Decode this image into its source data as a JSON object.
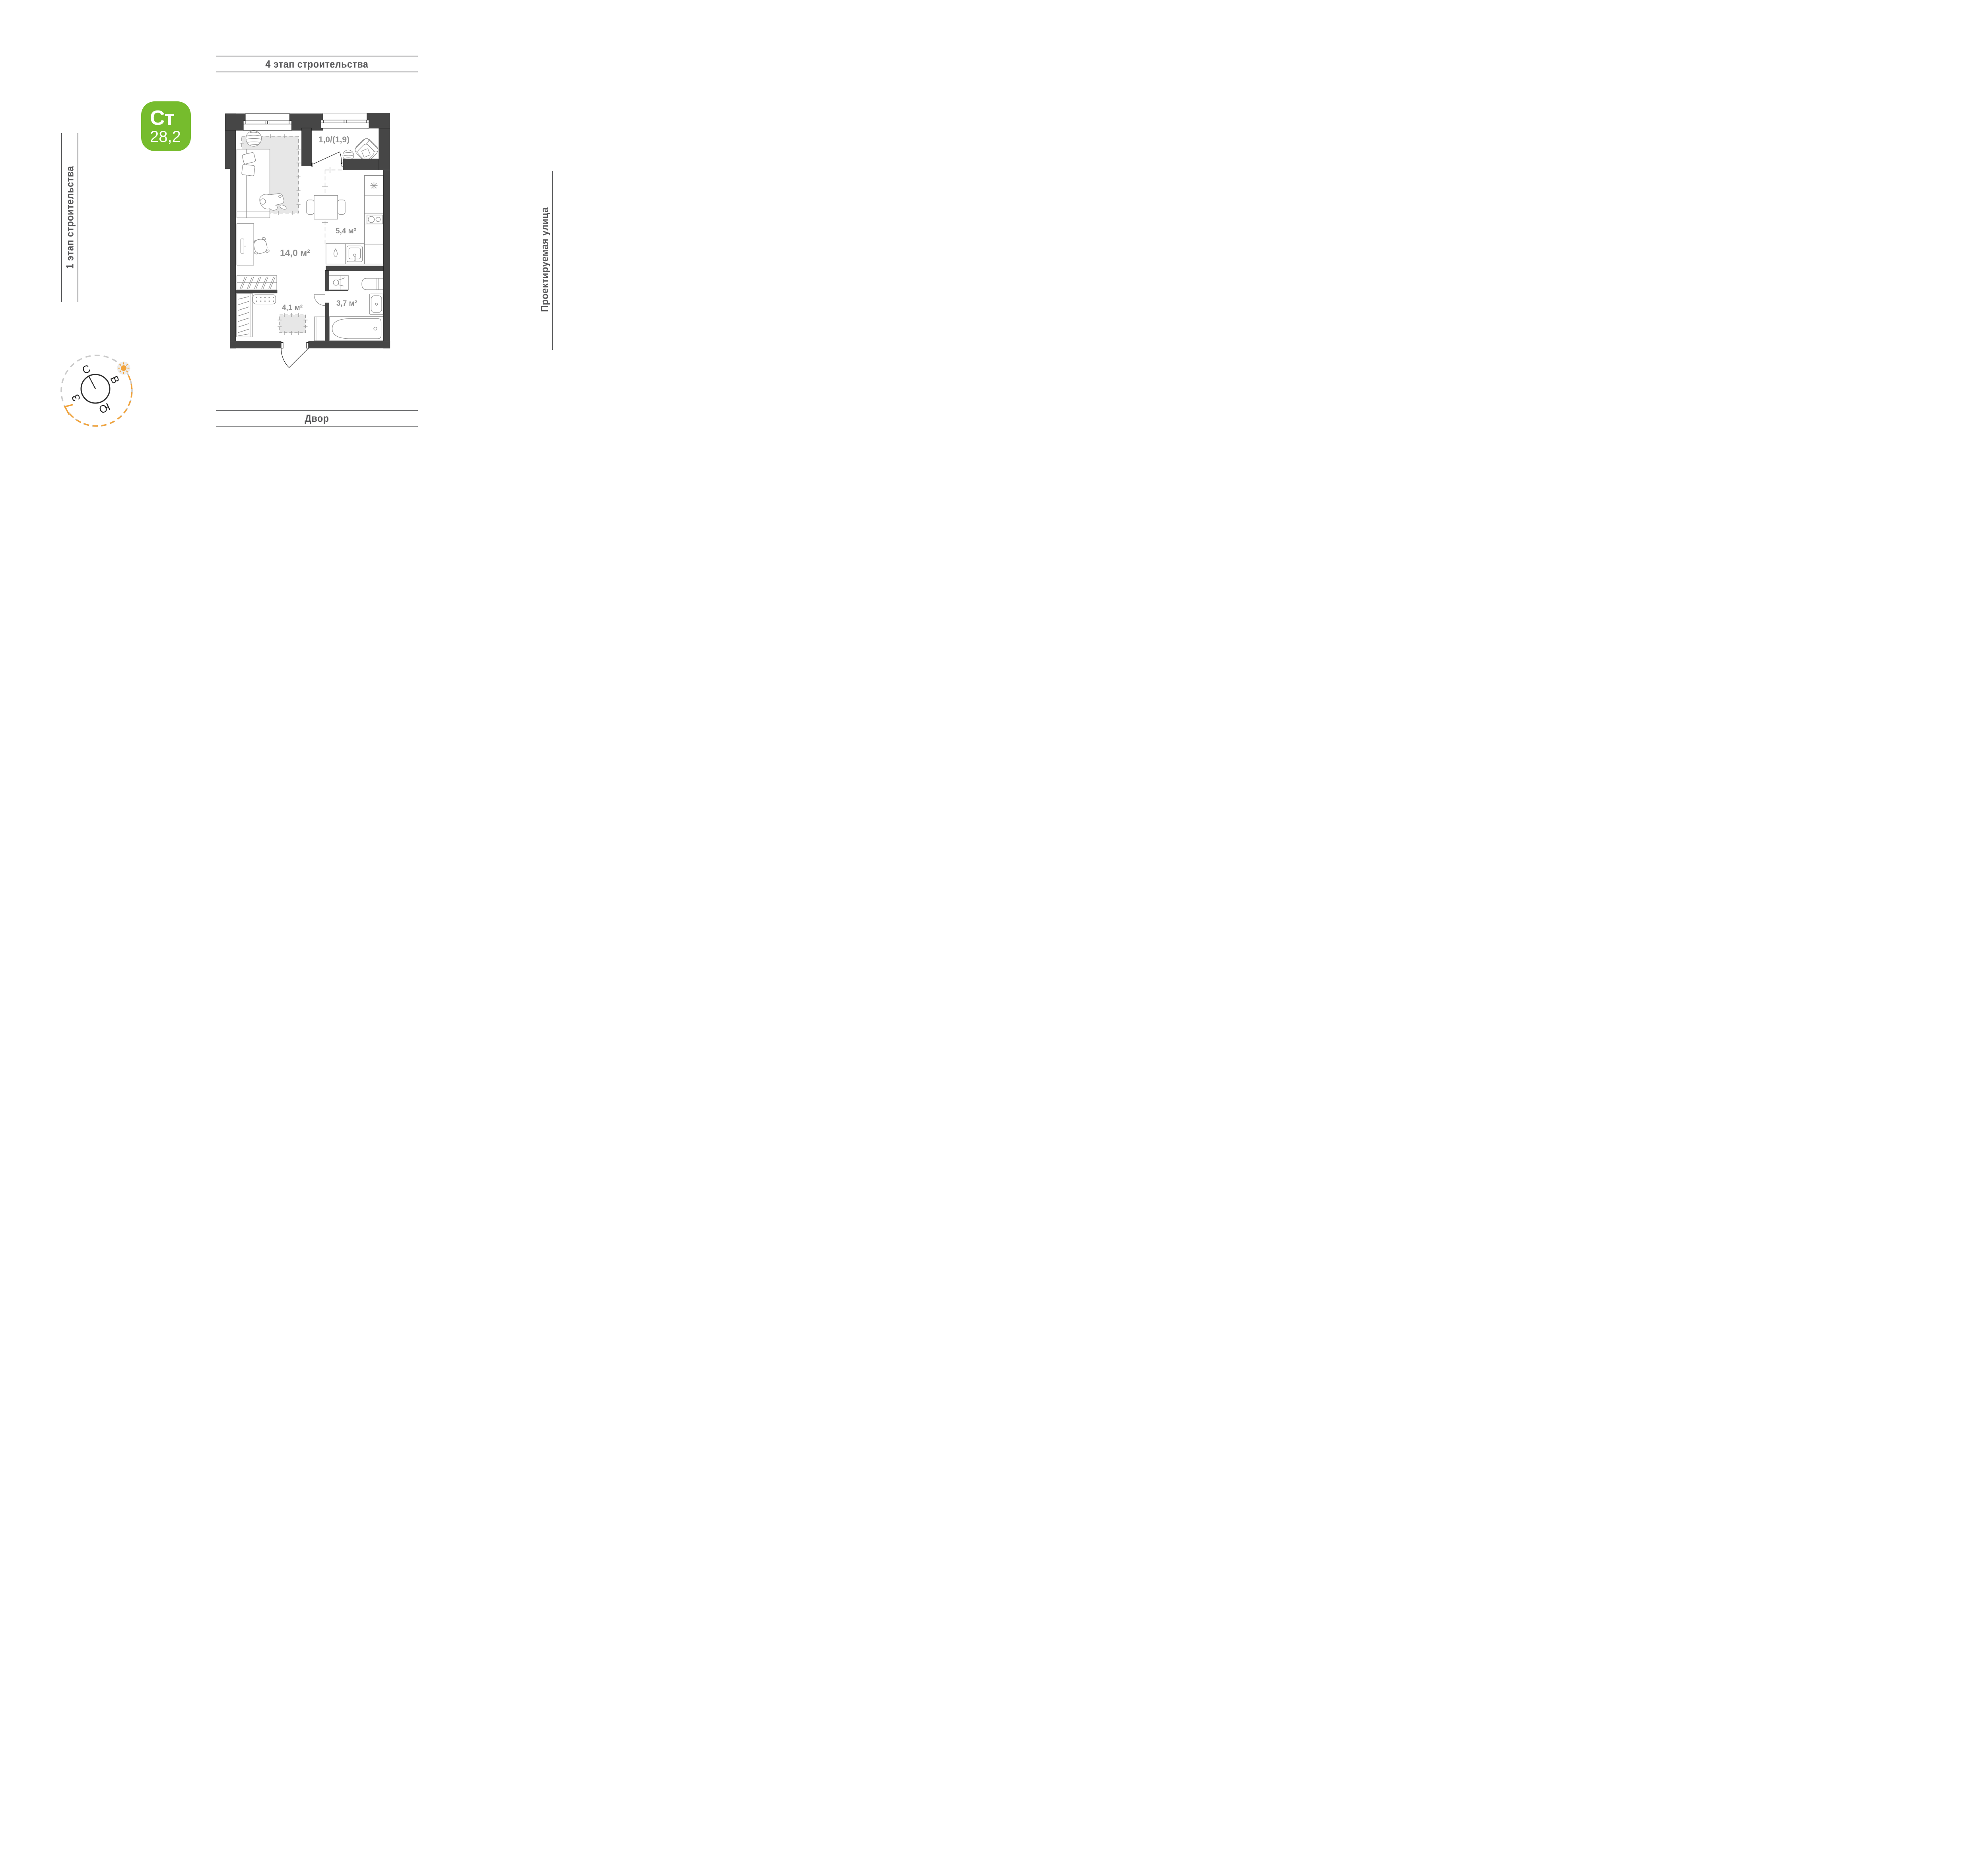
{
  "surroundings": {
    "top": {
      "label": "4 этап строительства"
    },
    "left": {
      "label": "1 этап строительства"
    },
    "right": {
      "label": "Проектируемая улица"
    },
    "bottom": {
      "label": "Двор"
    }
  },
  "badge": {
    "type_label": "Ст",
    "total_area": "28,2",
    "bg": "#76BC2D"
  },
  "plan": {
    "rooms": [
      {
        "id": "living",
        "area": "14,0 м²"
      },
      {
        "id": "kitchen",
        "area": "5,4 м²"
      },
      {
        "id": "hallway",
        "area": "4,1 м²"
      },
      {
        "id": "bathroom",
        "area": "3,7 м²"
      },
      {
        "id": "balcony",
        "area": "1,0/(1,9)"
      }
    ]
  },
  "compass": {
    "n": "С",
    "e": "В",
    "s": "Ю",
    "w": "З"
  },
  "colors": {
    "wall": "#464646",
    "furniture_line": "#8b8b8b",
    "room_label": "#8e8e8e",
    "zone_fill": "#e7e7e7",
    "accent_orange": "#F1A33B",
    "context_line": "#595a5c",
    "badge_green": "#76BC2D"
  }
}
